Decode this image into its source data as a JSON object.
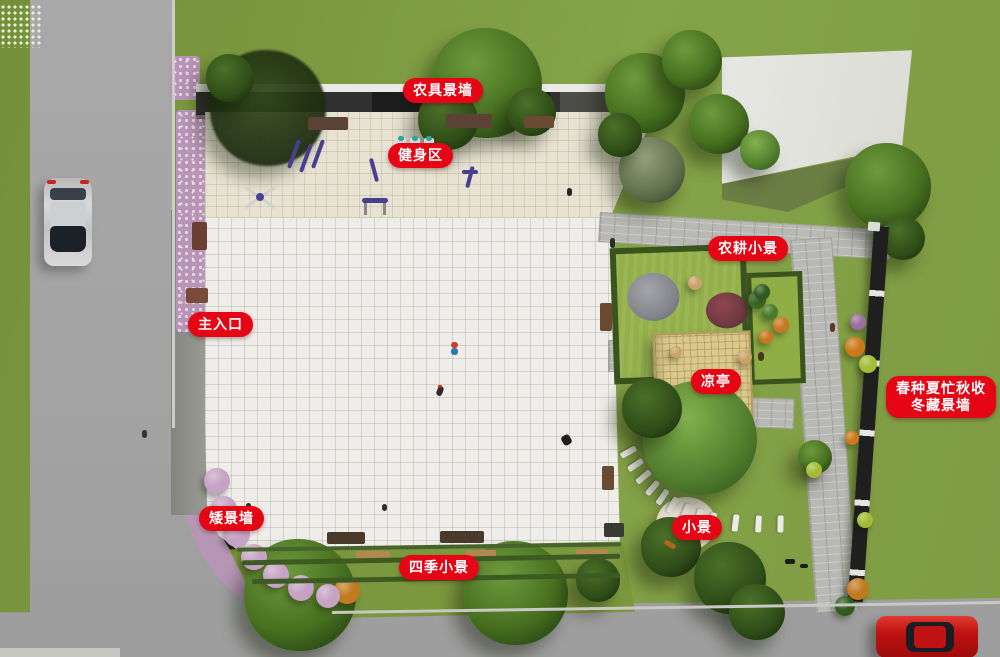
{
  "colors": {
    "label_bg": "#e60514",
    "label_text": "#ffffff",
    "grass": "#7d9a40",
    "road": "#a5a5a5",
    "plaza": "#eeede9"
  },
  "labels": [
    {
      "id": "farm-tool-wall",
      "text": "农具景墙"
    },
    {
      "id": "fitness-area",
      "text": "健身区"
    },
    {
      "id": "farming-scene",
      "text": "农耕小景"
    },
    {
      "id": "main-entrance",
      "text": "主入口"
    },
    {
      "id": "pavilion",
      "text": "凉亭"
    },
    {
      "id": "four-seasons-wall",
      "text": "春种夏忙秋收\n冬藏景墙"
    },
    {
      "id": "low-wall",
      "text": "矮景墙"
    },
    {
      "id": "small-scene",
      "text": "小景"
    },
    {
      "id": "four-seasons-scene",
      "text": "四季小景"
    }
  ],
  "scene": {
    "trees": [
      {
        "x": 268,
        "y": 108,
        "r": 58,
        "tone": "shadow"
      },
      {
        "x": 487,
        "y": 83,
        "r": 55,
        "tone": "main"
      },
      {
        "x": 448,
        "y": 120,
        "r": 30,
        "tone": "dark"
      },
      {
        "x": 532,
        "y": 112,
        "r": 24,
        "tone": "dark"
      },
      {
        "x": 645,
        "y": 93,
        "r": 40,
        "tone": "main"
      },
      {
        "x": 692,
        "y": 60,
        "r": 30,
        "tone": "main"
      },
      {
        "x": 719,
        "y": 124,
        "r": 30,
        "tone": "main"
      },
      {
        "x": 652,
        "y": 170,
        "r": 33,
        "tone": "gray"
      },
      {
        "x": 620,
        "y": 135,
        "r": 22,
        "tone": "dark"
      },
      {
        "x": 760,
        "y": 150,
        "r": 20,
        "tone": "light"
      },
      {
        "x": 888,
        "y": 186,
        "r": 43,
        "tone": "main"
      },
      {
        "x": 903,
        "y": 238,
        "r": 22,
        "tone": "dark"
      },
      {
        "x": 700,
        "y": 438,
        "r": 57,
        "tone": "light"
      },
      {
        "x": 652,
        "y": 408,
        "r": 30,
        "tone": "dark"
      },
      {
        "x": 671,
        "y": 547,
        "r": 30,
        "tone": "dark"
      },
      {
        "x": 730,
        "y": 578,
        "r": 36,
        "tone": "dark"
      },
      {
        "x": 757,
        "y": 612,
        "r": 28,
        "tone": "dark"
      },
      {
        "x": 300,
        "y": 595,
        "r": 56,
        "tone": "main"
      },
      {
        "x": 516,
        "y": 593,
        "r": 52,
        "tone": "main"
      },
      {
        "x": 598,
        "y": 580,
        "r": 22,
        "tone": "dark"
      },
      {
        "x": 815,
        "y": 457,
        "r": 17,
        "tone": "main"
      },
      {
        "x": 230,
        "y": 78,
        "r": 24,
        "tone": "dark"
      }
    ],
    "shrubs": [
      {
        "x": 347,
        "y": 591,
        "r": 13,
        "c": "#c27a1e"
      },
      {
        "x": 855,
        "y": 347,
        "r": 10,
        "c": "#cc7818"
      },
      {
        "x": 868,
        "y": 364,
        "r": 9,
        "c": "#a4bc34"
      },
      {
        "x": 858,
        "y": 322,
        "r": 8,
        "c": "#9b6fa0"
      },
      {
        "x": 814,
        "y": 470,
        "r": 8,
        "c": "#a4bc34"
      },
      {
        "x": 852,
        "y": 438,
        "r": 7,
        "c": "#cc7818"
      },
      {
        "x": 865,
        "y": 520,
        "r": 8,
        "c": "#a4bc34"
      },
      {
        "x": 858,
        "y": 589,
        "r": 11,
        "c": "#c27a1e"
      },
      {
        "x": 845,
        "y": 606,
        "r": 10,
        "c": "#2f5a1e"
      },
      {
        "x": 757,
        "y": 300,
        "r": 9,
        "c": "#3f6d26"
      },
      {
        "x": 770,
        "y": 312,
        "r": 8,
        "c": "#4a7a2a"
      },
      {
        "x": 762,
        "y": 292,
        "r": 8,
        "c": "#2f5a1e"
      },
      {
        "x": 781,
        "y": 325,
        "r": 8,
        "c": "#c87722"
      },
      {
        "x": 766,
        "y": 337,
        "r": 7,
        "c": "#c87722"
      },
      {
        "x": 695,
        "y": 283,
        "r": 7,
        "c": "#c9a368"
      },
      {
        "x": 676,
        "y": 352,
        "r": 6,
        "c": "#c9a368"
      },
      {
        "x": 745,
        "y": 357,
        "r": 7,
        "c": "#c9a368"
      },
      {
        "x": 217,
        "y": 481,
        "r": 13,
        "c": "#c6a2c4"
      },
      {
        "x": 224,
        "y": 509,
        "r": 13,
        "c": "#c6a2c4"
      },
      {
        "x": 237,
        "y": 534,
        "r": 13,
        "c": "#c6a2c4"
      },
      {
        "x": 254,
        "y": 557,
        "r": 13,
        "c": "#c6a2c4"
      },
      {
        "x": 276,
        "y": 575,
        "r": 13,
        "c": "#c6a2c4"
      },
      {
        "x": 301,
        "y": 588,
        "r": 13,
        "c": "#c6a2c4"
      },
      {
        "x": 328,
        "y": 596,
        "r": 12,
        "c": "#c6a2c4"
      }
    ],
    "stones": [
      {
        "x": 620,
        "y": 449,
        "deg": 151
      },
      {
        "x": 627,
        "y": 462,
        "deg": 146
      },
      {
        "x": 635,
        "y": 474,
        "deg": 140
      },
      {
        "x": 644,
        "y": 485,
        "deg": 131
      },
      {
        "x": 654,
        "y": 494,
        "deg": 125
      },
      {
        "x": 664,
        "y": 502,
        "deg": 119
      },
      {
        "x": 677,
        "y": 509,
        "deg": 113
      },
      {
        "x": 690,
        "y": 514,
        "deg": 107
      },
      {
        "x": 704,
        "y": 518,
        "deg": 103
      },
      {
        "x": 727,
        "y": 520,
        "deg": 97
      },
      {
        "x": 750,
        "y": 521,
        "deg": 93
      },
      {
        "x": 772,
        "y": 521,
        "deg": 91
      }
    ],
    "sprites": [
      {
        "x": 172,
        "y": 0,
        "w": 3,
        "h": 428,
        "deg": 0,
        "c": "#cdcdc9",
        "br": 0
      },
      {
        "x": 332,
        "y": 606,
        "w": 670,
        "h": 3,
        "deg": -0.85,
        "c": "#c8c8c4",
        "br": 0
      },
      {
        "x": 0,
        "y": 648,
        "w": 120,
        "h": 9,
        "deg": 0,
        "c": "#c6c6c2",
        "br": 0
      },
      {
        "x": 308,
        "y": 117,
        "w": 40,
        "h": 13,
        "deg": 0,
        "c": "#5a4234",
        "br": 2
      },
      {
        "x": 446,
        "y": 114,
        "w": 46,
        "h": 14,
        "deg": 0,
        "c": "#5a4234",
        "br": 2
      },
      {
        "x": 524,
        "y": 116,
        "w": 30,
        "h": 12,
        "deg": 0,
        "c": "#6b4a32",
        "br": 2
      },
      {
        "x": 186,
        "y": 288,
        "w": 22,
        "h": 15,
        "deg": 0,
        "c": "#7a4a3a",
        "br": 2
      },
      {
        "x": 192,
        "y": 222,
        "w": 15,
        "h": 28,
        "deg": 0,
        "c": "#6b4034",
        "br": 2
      },
      {
        "x": 600,
        "y": 303,
        "w": 12,
        "h": 28,
        "deg": 0,
        "c": "#6b4a32",
        "br": 2
      },
      {
        "x": 602,
        "y": 466,
        "w": 12,
        "h": 24,
        "deg": 0,
        "c": "#6b4a32",
        "br": 2
      },
      {
        "x": 327,
        "y": 532,
        "w": 38,
        "h": 12,
        "deg": 0,
        "c": "#4a3a2c",
        "br": 2
      },
      {
        "x": 440,
        "y": 531,
        "w": 44,
        "h": 12,
        "deg": 0,
        "c": "#4a3a2c",
        "br": 2
      },
      {
        "x": 604,
        "y": 523,
        "w": 20,
        "h": 14,
        "deg": 0,
        "c": "#3a3a34",
        "br": 2
      },
      {
        "x": 356,
        "y": 551,
        "w": 34,
        "h": 9,
        "deg": 0,
        "c": "#b08850",
        "br": 2
      },
      {
        "x": 466,
        "y": 550,
        "w": 30,
        "h": 9,
        "deg": 0,
        "c": "#b08850",
        "br": 2
      },
      {
        "x": 576,
        "y": 549,
        "w": 32,
        "h": 9,
        "deg": 0,
        "c": "#b08850",
        "br": 2
      },
      {
        "x": 237,
        "y": 545,
        "w": 384,
        "h": 4,
        "deg": -0.8,
        "c": "#45632a",
        "br": 1
      },
      {
        "x": 242,
        "y": 557,
        "w": 378,
        "h": 5,
        "deg": -1,
        "c": "#3c5a22",
        "br": 2
      },
      {
        "x": 252,
        "y": 576,
        "w": 368,
        "h": 5,
        "deg": -1,
        "c": "#3c5a22",
        "br": 2
      },
      {
        "x": 292,
        "y": 139,
        "w": 4,
        "h": 30,
        "deg": 20,
        "c": "#4a3f8f",
        "br": 2
      },
      {
        "x": 304,
        "y": 143,
        "w": 4,
        "h": 30,
        "deg": 20,
        "c": "#4a3f8f",
        "br": 2
      },
      {
        "x": 316,
        "y": 139,
        "w": 4,
        "h": 30,
        "deg": 20,
        "c": "#4a3f8f",
        "br": 2
      },
      {
        "x": 372,
        "y": 158,
        "w": 4,
        "h": 24,
        "deg": -15,
        "c": "#4a3f8f",
        "br": 2
      },
      {
        "x": 396,
        "y": 138,
        "w": 10,
        "h": 14,
        "deg": 0,
        "c": "#d8dee0",
        "br": 2
      },
      {
        "x": 410,
        "y": 138,
        "w": 10,
        "h": 14,
        "deg": 0,
        "c": "#d8dee0",
        "br": 2
      },
      {
        "x": 424,
        "y": 138,
        "w": 10,
        "h": 14,
        "deg": 0,
        "c": "#d8dee0",
        "br": 2
      },
      {
        "x": 398,
        "y": 136,
        "w": 6,
        "h": 5,
        "deg": 0,
        "c": "#2aa6a0",
        "br": 3
      },
      {
        "x": 412,
        "y": 136,
        "w": 6,
        "h": 5,
        "deg": 0,
        "c": "#2aa6a0",
        "br": 3
      },
      {
        "x": 426,
        "y": 136,
        "w": 6,
        "h": 5,
        "deg": 0,
        "c": "#2aa6a0",
        "br": 3
      },
      {
        "x": 242,
        "y": 196,
        "w": 36,
        "h": 3,
        "deg": 35,
        "c": "#cfd2cc",
        "br": 1
      },
      {
        "x": 242,
        "y": 196,
        "w": 36,
        "h": 3,
        "deg": -35,
        "c": "#cfd2cc",
        "br": 1
      },
      {
        "x": 256,
        "y": 193,
        "w": 8,
        "h": 8,
        "deg": 0,
        "c": "#4a3f8f",
        "br": 4
      },
      {
        "x": 362,
        "y": 198,
        "w": 26,
        "h": 5,
        "deg": 0,
        "c": "#4a3f8f",
        "br": 3
      },
      {
        "x": 364,
        "y": 203,
        "w": 3,
        "h": 12,
        "deg": 0,
        "c": "#888888",
        "br": 0
      },
      {
        "x": 383,
        "y": 203,
        "w": 3,
        "h": 12,
        "deg": 0,
        "c": "#888888",
        "br": 0
      },
      {
        "x": 468,
        "y": 166,
        "w": 4,
        "h": 22,
        "deg": 15,
        "c": "#4a3f8f",
        "br": 2
      },
      {
        "x": 462,
        "y": 170,
        "w": 16,
        "h": 4,
        "deg": 0,
        "c": "#4a3f8f",
        "br": 2
      },
      {
        "x": 868,
        "y": 222,
        "w": 12,
        "h": 9,
        "deg": 4,
        "c": "#dcdcd8",
        "br": 1
      },
      {
        "x": 664,
        "y": 542,
        "w": 12,
        "h": 5,
        "deg": 30,
        "c": "#b5651d",
        "br": 2
      },
      {
        "x": 451,
        "y": 342,
        "w": 7,
        "h": 6,
        "deg": 0,
        "c": "#d03a28",
        "br": 3
      },
      {
        "x": 451,
        "y": 348,
        "w": 7,
        "h": 7,
        "deg": 0,
        "c": "#2a7ab0",
        "br": 3
      },
      {
        "x": 437,
        "y": 386,
        "w": 6,
        "h": 10,
        "deg": 20,
        "c": "#2b2b2b",
        "br": 3
      },
      {
        "x": 438,
        "y": 385,
        "w": 4,
        "h": 3,
        "deg": 0,
        "c": "#cc2222",
        "br": 2
      },
      {
        "x": 562,
        "y": 435,
        "w": 9,
        "h": 10,
        "deg": -30,
        "c": "#1e1e1e",
        "br": 3
      },
      {
        "x": 419,
        "y": 158,
        "w": 5,
        "h": 9,
        "deg": 0,
        "c": "#252525",
        "br": 3
      },
      {
        "x": 567,
        "y": 188,
        "w": 5,
        "h": 8,
        "deg": 0,
        "c": "#252525",
        "br": 3
      },
      {
        "x": 610,
        "y": 238,
        "w": 5,
        "h": 10,
        "deg": 0,
        "c": "#2c2c2c",
        "br": 3
      },
      {
        "x": 830,
        "y": 323,
        "w": 5,
        "h": 9,
        "deg": 0,
        "c": "#5a3a22",
        "br": 3
      },
      {
        "x": 142,
        "y": 430,
        "w": 5,
        "h": 8,
        "deg": 0,
        "c": "#333333",
        "br": 3
      },
      {
        "x": 237,
        "y": 506,
        "w": 6,
        "h": 6,
        "deg": 0,
        "c": "#2a2a2a",
        "br": 3
      },
      {
        "x": 246,
        "y": 503,
        "w": 5,
        "h": 6,
        "deg": 0,
        "c": "#3a2a20",
        "br": 3
      },
      {
        "x": 785,
        "y": 559,
        "w": 10,
        "h": 5,
        "deg": 0,
        "c": "#1d1d1d",
        "br": 2
      },
      {
        "x": 800,
        "y": 564,
        "w": 8,
        "h": 4,
        "deg": 0,
        "c": "#1d1d1d",
        "br": 2
      },
      {
        "x": 382,
        "y": 504,
        "w": 5,
        "h": 7,
        "deg": 0,
        "c": "#2f2f2f",
        "br": 3
      },
      {
        "x": 758,
        "y": 352,
        "w": 6,
        "h": 9,
        "deg": 0,
        "c": "#4a3520",
        "br": 3
      }
    ]
  }
}
